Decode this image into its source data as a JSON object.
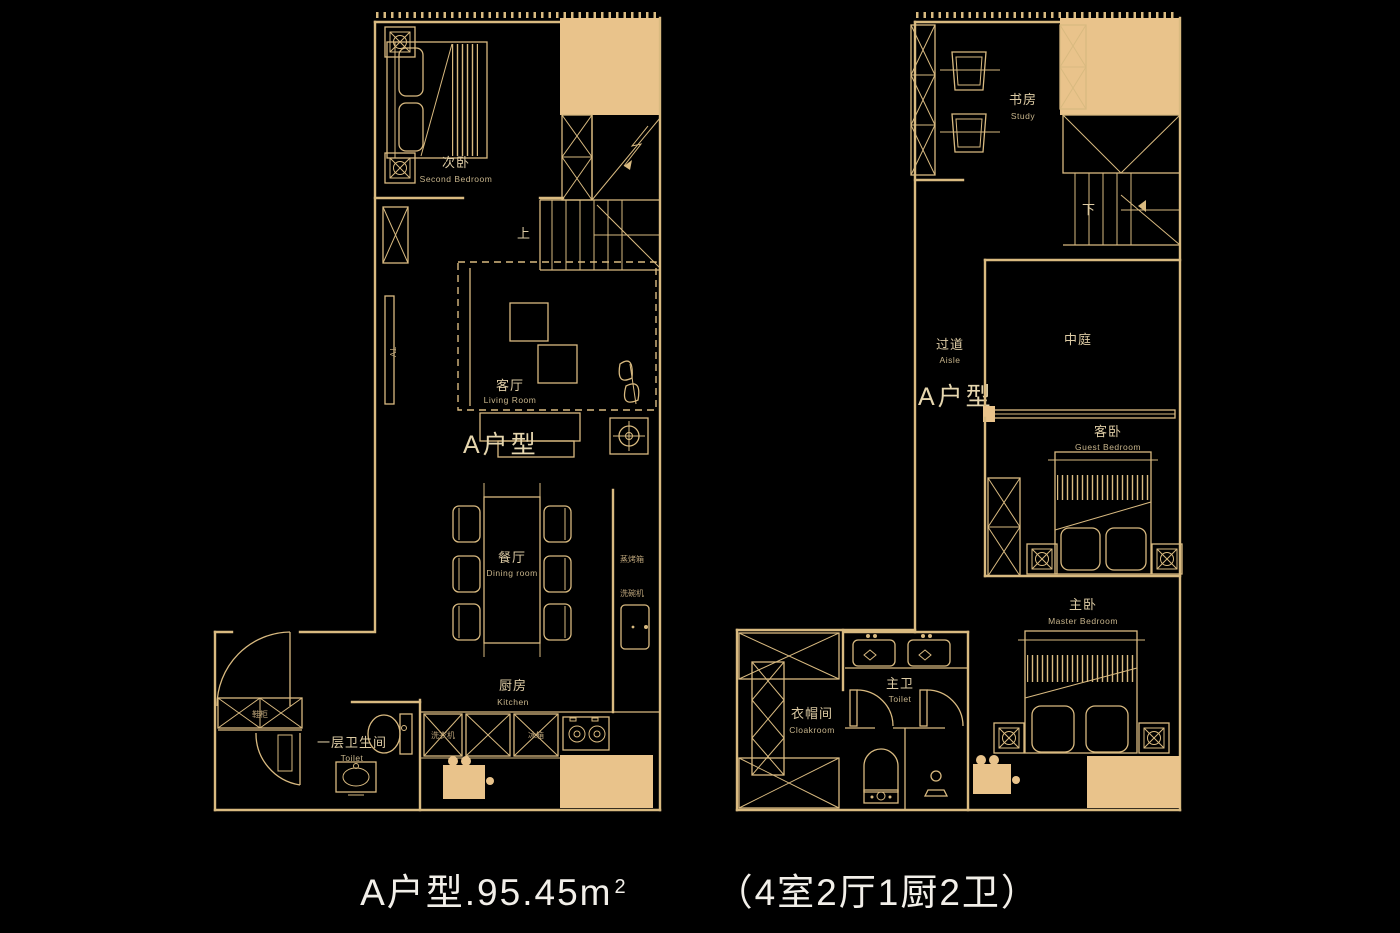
{
  "colors": {
    "background": "#000000",
    "line": "#d9ba80",
    "fill": "#e9c38b",
    "label": "#ddcba4",
    "caption": "#f2efe9"
  },
  "caption": {
    "area_text": "A户型.95.45m",
    "area_sup": "2",
    "spec_text": "（4室2厅1厨2卫）"
  },
  "floor1": {
    "unit_label": "A户型",
    "stairs_up": "上",
    "tv": "TV",
    "rooms": {
      "second_bedroom": {
        "zh": "次卧",
        "en": "Second Bedroom"
      },
      "living_room": {
        "zh": "客厅",
        "en": "Living Room"
      },
      "dining_room": {
        "zh": "餐厅",
        "en": "Dining room"
      },
      "kitchen": {
        "zh": "厨房",
        "en": "Kitchen"
      },
      "toilet": {
        "zh": "一层卫生间",
        "en": "Toilet"
      }
    },
    "appliances": {
      "steam_oven": "蒸烤箱",
      "dishwasher": "洗碗机",
      "washer": "洗衣机",
      "fridge": "冰箱",
      "shoe_cabinet": "鞋柜"
    }
  },
  "floor2": {
    "unit_label": "A户型",
    "stairs_down": "下",
    "rooms": {
      "study": {
        "zh": "书房",
        "en": "Study"
      },
      "aisle": {
        "zh": "过道",
        "en": "Aisle"
      },
      "atrium": {
        "zh": "中庭"
      },
      "guest_bedroom": {
        "zh": "客卧",
        "en": "Guest Bedroom"
      },
      "master_bedroom": {
        "zh": "主卧",
        "en": "Master Bedroom"
      },
      "master_toilet": {
        "zh": "主卫",
        "en": "Toilet"
      },
      "cloakroom": {
        "zh": "衣帽间",
        "en": "Cloakroom"
      }
    }
  }
}
